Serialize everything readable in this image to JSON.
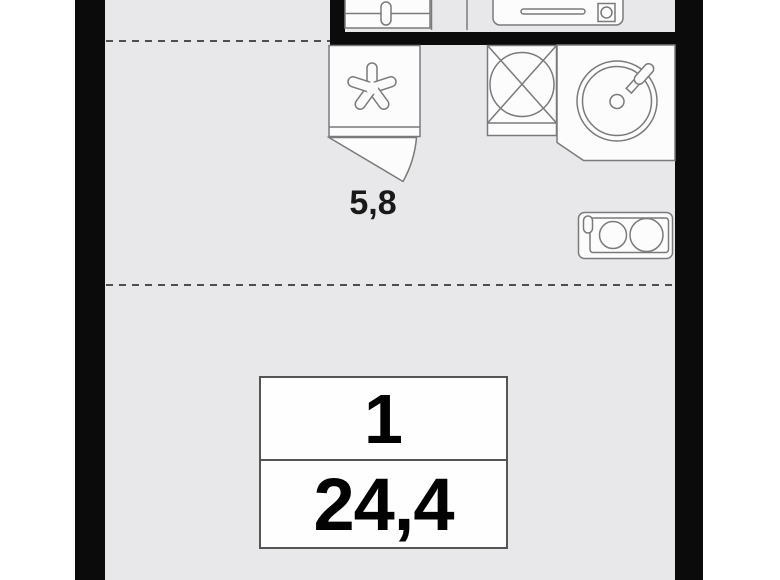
{
  "floor_plan": {
    "unit": {
      "rooms_count": "1",
      "total_area": "24,4",
      "kitchen_area": "5,8"
    },
    "fixtures": [
      {
        "icon": "wash-basin-icon",
        "label": "wash basin with faucet (cut off at top edge)"
      },
      {
        "icon": "bathtub-icon",
        "label": "bathtub with drain (cut off at top edge)"
      },
      {
        "icon": "fridge-snowflake-icon",
        "label": "refrigerator marked with snowflake asterisk"
      },
      {
        "icon": "door-swing-icon",
        "label": "door swing arc below refrigerator"
      },
      {
        "icon": "washing-machine-icon",
        "label": "appliance square with inscribed circle and cross"
      },
      {
        "icon": "kitchen-sink-icon",
        "label": "round sink with faucet on corner counter"
      },
      {
        "icon": "cooktop-icon",
        "label": "two-burner cooktop against right wall"
      }
    ],
    "colors": {
      "wall": "#0b0b0b",
      "floor": "#e8e8ea",
      "outside": "#ffffff",
      "fixture_fill": "#fcfcfc",
      "fixture_stroke": "#7a7a7a",
      "dashed_line": "#4e4e4e",
      "label_text": "#020202"
    }
  }
}
